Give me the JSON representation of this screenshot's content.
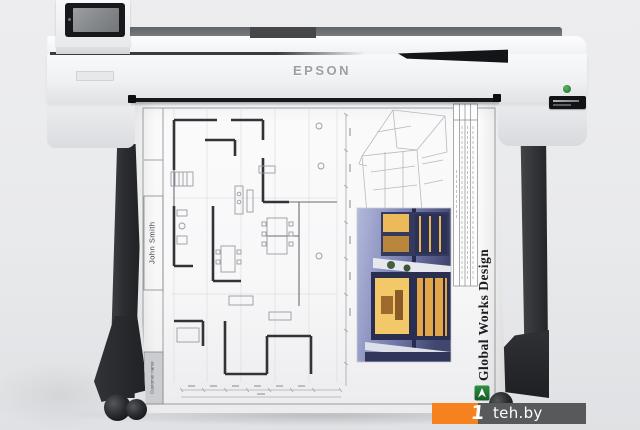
{
  "meta": {
    "description": "Product photo of a white Epson large-format inkjet plotter on a black wheeled stand, printing an architectural floor-plan sheet",
    "image_type": "product-photo"
  },
  "printer": {
    "brand": "EPSON",
    "parts": [
      "touchscreen-control-panel",
      "roll-cover",
      "front-panel",
      "paper-exit-slot",
      "stand-legs",
      "casters"
    ]
  },
  "sheet": {
    "customer_label": "Customer name",
    "customer_name": "John Smith",
    "studio_title": "Global Works Design",
    "content": [
      "architectural floor plan with walls and furniture",
      "dimension chains",
      "3D wireframe house drawing",
      "night photo of modern house",
      "rotated notes table"
    ]
  },
  "watermark": {
    "prefix": "1",
    "site": "teh.by"
  },
  "icons": {
    "gwd_logo": "green-square-white-arrow",
    "eco_badge": "green-eco-dot",
    "model_badge": "black-nameplate"
  },
  "colors": {
    "watermark_orange": "#F5821F",
    "watermark_gray": "#58595B",
    "logo_green": "#1F7A34",
    "leg_black": "#26272A",
    "body_white": "#F2F3F5"
  }
}
